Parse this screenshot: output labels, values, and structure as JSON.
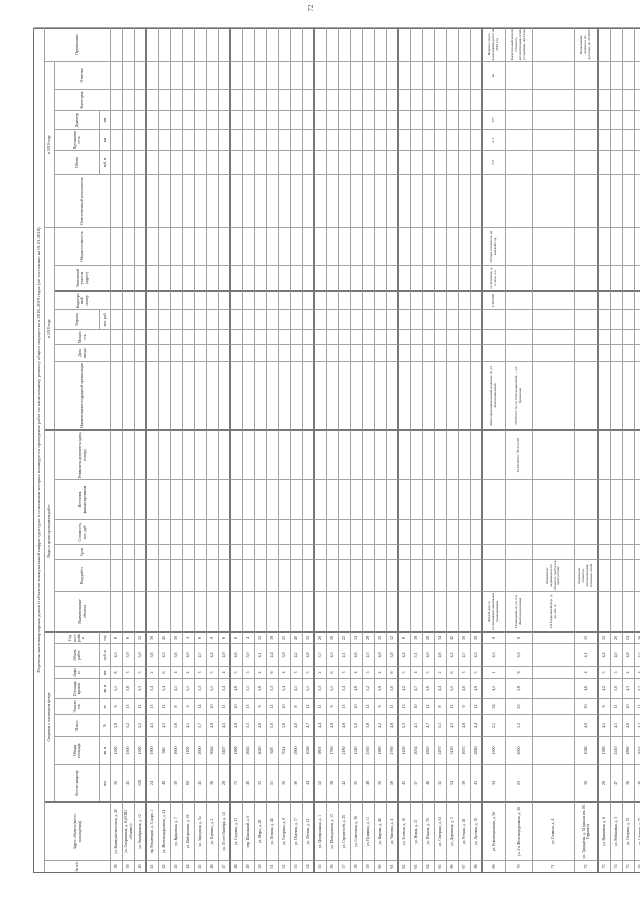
{
  "page": {
    "number": "72"
  },
  "colors": {
    "grid_line": "#a3a3a3",
    "heavy_line": "#777777",
    "text": "#1f1f1f",
    "paper": "#ffffff"
  },
  "table": {
    "title": "Перечень многоквартирных домов и объектов коммунальной инфраструктуры, в отношении которых планируется проведение работ по капитальному ремонту общего имущества в 2018–2019 годах (по состоянию на 01.01.2018)",
    "groups": [
      {
        "label": "Сведения о жилищном фонде",
        "from": 3,
        "to": 10
      },
      {
        "label": "Виды и сроки проведения работ",
        "from": 11,
        "to": 16
      },
      {
        "label": "в 2018 году",
        "from": 17,
        "to": 23
      },
      {
        "label": "в 2019 году",
        "from": 24,
        "to": 29
      }
    ],
    "columns": [
      {
        "id": "c1",
        "width": 12,
        "label": "№ п/п",
        "fullspan": true
      },
      {
        "id": "c2",
        "width": 59,
        "label": "Адрес объекта (место нахождения)",
        "fullspan": true,
        "heavy": true
      },
      {
        "id": "c3",
        "width": 37,
        "label": "Кол-во квартир",
        "unit": "шт."
      },
      {
        "id": "c4",
        "width": 28,
        "label": "Общая площадь",
        "unit": "кв. м"
      },
      {
        "id": "c5",
        "width": 22,
        "label": "Износ",
        "unit": "%"
      },
      {
        "id": "c6",
        "width": 16,
        "label": "Этажность",
        "unit": "эт."
      },
      {
        "id": "c7",
        "width": 20,
        "label": "Площадь кровли",
        "unit": "кв. м"
      },
      {
        "id": "c8",
        "width": 12,
        "label": "Лифты",
        "unit": "шт."
      },
      {
        "id": "c9",
        "width": 23,
        "label": "Объем работ",
        "unit": "куб. м"
      },
      {
        "id": "c10",
        "width": 12,
        "label": "Год постройки",
        "unit": "год",
        "heavy": true
      },
      {
        "id": "c11",
        "width": 40,
        "label": "Наименование объекта"
      },
      {
        "id": "c12",
        "width": 32,
        "label": "Вид работ"
      },
      {
        "id": "c13",
        "width": 15,
        "label": "Срок"
      },
      {
        "id": "c14",
        "width": 25,
        "label": "Стоимость, тыс. руб."
      },
      {
        "id": "c15",
        "width": 40,
        "label": "Источник финансирования"
      },
      {
        "id": "c16",
        "width": 50,
        "label": "Реквизиты документа (дата, номер)",
        "heavy": true
      },
      {
        "id": "c17",
        "width": 68,
        "label": "Наименование подрядной организации"
      },
      {
        "id": "c18",
        "width": 17,
        "label": "Дата ввода"
      },
      {
        "id": "c19",
        "width": 15,
        "label": "Мощность"
      },
      {
        "id": "c20",
        "width": 20,
        "label": "Затраты",
        "unit": "тыс. руб."
      },
      {
        "id": "c21",
        "width": 19,
        "label": "Кадастровый номер",
        "heavy": true
      },
      {
        "id": "c22",
        "width": 25,
        "label": "Земельный участок (адрес)"
      },
      {
        "id": "c23",
        "width": 38,
        "label": "Общая готовность"
      },
      {
        "id": "c24",
        "width": 53,
        "label": "Ответственный исполнитель"
      },
      {
        "id": "c25",
        "width": 24,
        "label": "Объем",
        "unit": "куб. м"
      },
      {
        "id": "c26",
        "width": 21,
        "label": "Протяженность",
        "unit": "км"
      },
      {
        "id": "c27",
        "width": 19,
        "label": "Диаметр",
        "unit": "мм"
      },
      {
        "id": "c28",
        "width": 21,
        "label": "Категория"
      },
      {
        "id": "c29",
        "width": 28,
        "label": "Отметка"
      },
      {
        "id": "c30",
        "width": 34,
        "label": "Примечание",
        "fullspan": true
      }
    ],
    "header_row_heights": [
      11,
      10,
      45,
      11
    ],
    "heavy_after_data_rows": [
      3,
      10,
      17,
      24,
      31,
      35
    ],
    "rows": [
      {
        "n": "38",
        "a": "ул. Коммунистическая, д. 45",
        "v": [
          "30",
          "1500",
          "3,9",
          "9",
          "5,1",
          "8",
          "4,5",
          "8"
        ]
      },
      {
        "n": "39",
        "a": "ул. Спортивная, д. 8 (СОШ «Олимп»)",
        "v": [
          "45",
          "1500",
          "5,2",
          "13",
          "3,8",
          "3",
          "3,9",
          "6"
        ]
      },
      {
        "n": "40",
        "a": "ул. Октябрьская, д. 12",
        "v": [
          "150",
          "1500",
          "5,5",
          "11",
          "3,3",
          "5",
          "5,0",
          "15"
        ]
      },
      {
        "n": "41",
        "a": "пр. Революции, д. 3, корп. 1",
        "v": [
          "24",
          "1900",
          "4,5",
          "13",
          "3,4",
          "2",
          "3,6",
          "30"
        ]
      },
      {
        "n": "42",
        "a": "ул. Железнодорожная, д. 24",
        "v": [
          "49",
          "940",
          "4,3",
          "11",
          "5,4",
          "6",
          "4,3",
          "45"
        ]
      },
      {
        "n": "43",
        "a": "ул. Крымская, д. 7",
        "v": [
          "30",
          "1600",
          "5,6",
          "8",
          "4,1",
          "4",
          "3,6",
          "50"
        ]
      },
      {
        "n": "44",
        "a": "ул. Набережная, д. 19",
        "v": [
          "60",
          "1100",
          "4,1",
          "4",
          "5,1",
          "2",
          "4,0",
          "4"
        ]
      },
      {
        "n": "45",
        "a": "ул. Заводская, д. 5а",
        "v": [
          "45",
          "2000",
          "5,7",
          "14",
          "5,3",
          "3",
          "4,7",
          "6"
        ]
      },
      {
        "n": "46",
        "a": "ул. Баумана, д. 2",
        "v": [
          "36",
          "3644",
          "4,9",
          "10",
          "5,1",
          "5",
          "4,4",
          "9"
        ]
      },
      {
        "n": "47",
        "a": "ул. 10 лет Октября, д. 14",
        "v": [
          "28",
          "3407",
          "4,5",
          "11",
          "3,4",
          "4",
          "4,9",
          "6"
        ]
      },
      {
        "n": "48",
        "a": "ул. Садовая, д. 31",
        "v": [
          "75",
          "1906",
          "4,9",
          "10",
          "4,8",
          "3",
          "4,6",
          "6"
        ]
      },
      {
        "n": "49",
        "a": "пер. Школьный, д. 6",
        "v": [
          "40",
          "2645",
          "3,1",
          "13",
          "5,1",
          "5",
          "5,0",
          "4"
        ]
      },
      {
        "n": "50",
        "a": "ул. Мира, д. 28",
        "v": [
          "33",
          "4020",
          "4,6",
          "9",
          "3,8",
          "2",
          "4,1",
          "12"
        ]
      },
      {
        "n": "51",
        "a": "ул. Ленина, д. 44",
        "v": [
          "51",
          "628",
          "5,0",
          "12",
          "3,3",
          "6",
          "4,4",
          "18"
        ]
      },
      {
        "n": "52",
        "a": "ул. Гагарина, д. 9",
        "v": [
          "30",
          "7014",
          "3,6",
          "10",
          "5,4",
          "4",
          "3,9",
          "25"
        ]
      },
      {
        "n": "53",
        "a": "ул. Полевая, д. 17",
        "v": [
          "36",
          "2900",
          "4,0",
          "8",
          "4,1",
          "3",
          "4,2",
          "40"
        ]
      },
      {
        "n": "54",
        "a": "ул. Лесная, д. 22",
        "v": [
          "44",
          "1049",
          "4,7",
          "12",
          "5,1",
          "5",
          "4,8",
          "35"
        ]
      },
      {
        "n": "55",
        "a": "ул. Центральная, д. 1",
        "v": [
          "52",
          "3801",
          "4,4",
          "11",
          "5,3",
          "2",
          "3,7",
          "20"
        ]
      },
      {
        "n": "56",
        "a": "ул. Молодежная, д. 13",
        "v": [
          "38",
          "1760",
          "4,9",
          "9",
          "5,1",
          "6",
          "4,5",
          "16"
        ]
      },
      {
        "n": "57",
        "a": "ул. Строителей, д. 25",
        "v": [
          "42",
          "2180",
          "4,6",
          "13",
          "3,4",
          "3",
          "4,1",
          "22"
        ]
      },
      {
        "n": "58",
        "a": "ул. Советская, д. 36",
        "v": [
          "35",
          "1540",
          "5,0",
          "10",
          "4,8",
          "4",
          "4,6",
          "14"
        ]
      },
      {
        "n": "59",
        "a": "ул. Пушкина, д. 11",
        "v": [
          "48",
          "2330",
          "3,8",
          "12",
          "5,2",
          "5",
          "4,3",
          "28"
        ]
      },
      {
        "n": "60",
        "a": "ул. Кирова, д. 40",
        "v": [
          "30",
          "1980",
          "4,2",
          "9",
          "3,9",
          "2",
          "4,9",
          "10"
        ]
      },
      {
        "n": "61",
        "a": "ул. Чапаева, д. 4",
        "v": [
          "56",
          "2760",
          "4,8",
          "11",
          "5,0",
          "6",
          "3,8",
          "12"
        ]
      },
      {
        "n": "62",
        "a": "ул. Зеленая, д. 16",
        "v": [
          "41",
          "1430",
          "5,3",
          "13",
          "4,2",
          "3",
          "4,4",
          "8"
        ]
      },
      {
        "n": "63",
        "a": "ул. Новая, д. 21",
        "v": [
          "37",
          "2054",
          "4,1",
          "10",
          "4,7",
          "4",
          "5,1",
          "18"
        ]
      },
      {
        "n": "64",
        "a": "ул. Южная, д. 7б",
        "v": [
          "46",
          "1820",
          "4,7",
          "12",
          "3,6",
          "5",
          "4,0",
          "26"
        ]
      },
      {
        "n": "65",
        "a": "ул. Северная, д. 33",
        "v": [
          "32",
          "2470",
          "5,1",
          "8",
          "4,4",
          "2",
          "4,6",
          "34"
        ]
      },
      {
        "n": "66",
        "a": "ул. Дорожная, д. 2",
        "v": [
          "54",
          "3120",
          "4,3",
          "11",
          "5,5",
          "6",
          "4,2",
          "42"
        ]
      },
      {
        "n": "67",
        "a": "ул. Речная, д. 18",
        "v": [
          "39",
          "1675",
          "4,8",
          "9",
          "4,0",
          "3",
          "4,7",
          "50"
        ]
      },
      {
        "n": "68",
        "a": "ул. Луговая, д. 10",
        "v": [
          "43",
          "2840",
          "4,4",
          "12",
          "4,9",
          "5",
          "4,3",
          "30"
        ]
      },
      {
        "n": "69",
        "h": 23,
        "a": "ул. Революционная, д. 56",
        "v": [
          "34",
          "1500",
          "2,1",
          "34",
          "4,5",
          "1",
          "4,5",
          "9"
        ],
        "x": {
          "c11": "Жилой дом со встроенными нежилыми помещениями",
          "c17": "Многофункциональный комплекс по ул. Революционной",
          "c21": "1/100569",
          "c22": "ул. Баумана, д. 2, пом. 2-к",
          "c23": "Общая готовность на каждый год",
          "c25": "5,8",
          "c26": "к-7",
          "c27": "177",
          "c29": "вк",
          "c30": "Перенос срока выполнения работ на 2019 год"
        }
      },
      {
        "n": "70",
        "h": 27,
        "a": "ул. 2-я Железнодорожная, д. 30",
        "v": [
          "23",
          "2000",
          "1,2",
          "23",
          "3,8",
          "9",
          "3,9",
          "9"
        ],
        "x": {
          "c11": "Помещение по ул. 2-я Железнодорожная",
          "c16": "12.09.2016 г. № 94-1/95",
          "c17": "170504,57 по ул. Революционной — ул. Крымская",
          "c30": "Капитальный ремонт объектов, автоматизация сетей, устранение протечек"
        }
      },
      {
        "n": "71",
        "h": 42,
        "a": "ул. Главная, д. 4",
        "v": [
          "",
          "",
          "",
          "",
          "",
          "",
          "",
          ""
        ],
        "x": {
          "c11": "1-й Раздельный пер., д. 12, лит. А",
          "c12": "Капремонт недвижимости объектов, требуется присутствие"
        }
      },
      {
        "n": "72",
        "h": 24,
        "a": "ул. Тридцатая, д. 52 (школа им. М. Горького)",
        "v": [
          "30",
          "1046",
          "4,0",
          "10",
          "4,6",
          "4",
          "4,1",
          "15"
        ],
        "x": {
          "c12": "Капремонт объектов, автоматизация тепловых сетей",
          "c30": "Выполнение переноса по договору до 10.2019"
        }
      },
      {
        "n": "73",
        "a": "ул. Вишневая, д. 8",
        "v": [
          "29",
          "1380",
          "4,5",
          "9",
          "4,2",
          "3",
          "4,4",
          "12"
        ]
      },
      {
        "n": "74",
        "a": "ул. Рябиновая, д. 3",
        "v": [
          "47",
          "2210",
          "4,1",
          "11",
          "5,0",
          "5",
          "4,0",
          "20"
        ]
      },
      {
        "n": "75",
        "a": "ул. Озерная, д. 15",
        "v": [
          "36",
          "1890",
          "4,6",
          "10",
          "4,3",
          "2",
          "4,8",
          "24"
        ]
      },
      {
        "n": "76",
        "a": "ул. Степная, д. 27",
        "v": [
          "40",
          "2055",
          "4,2",
          "12",
          "4,7",
          "4",
          "4,5",
          "16"
        ]
      }
    ]
  }
}
